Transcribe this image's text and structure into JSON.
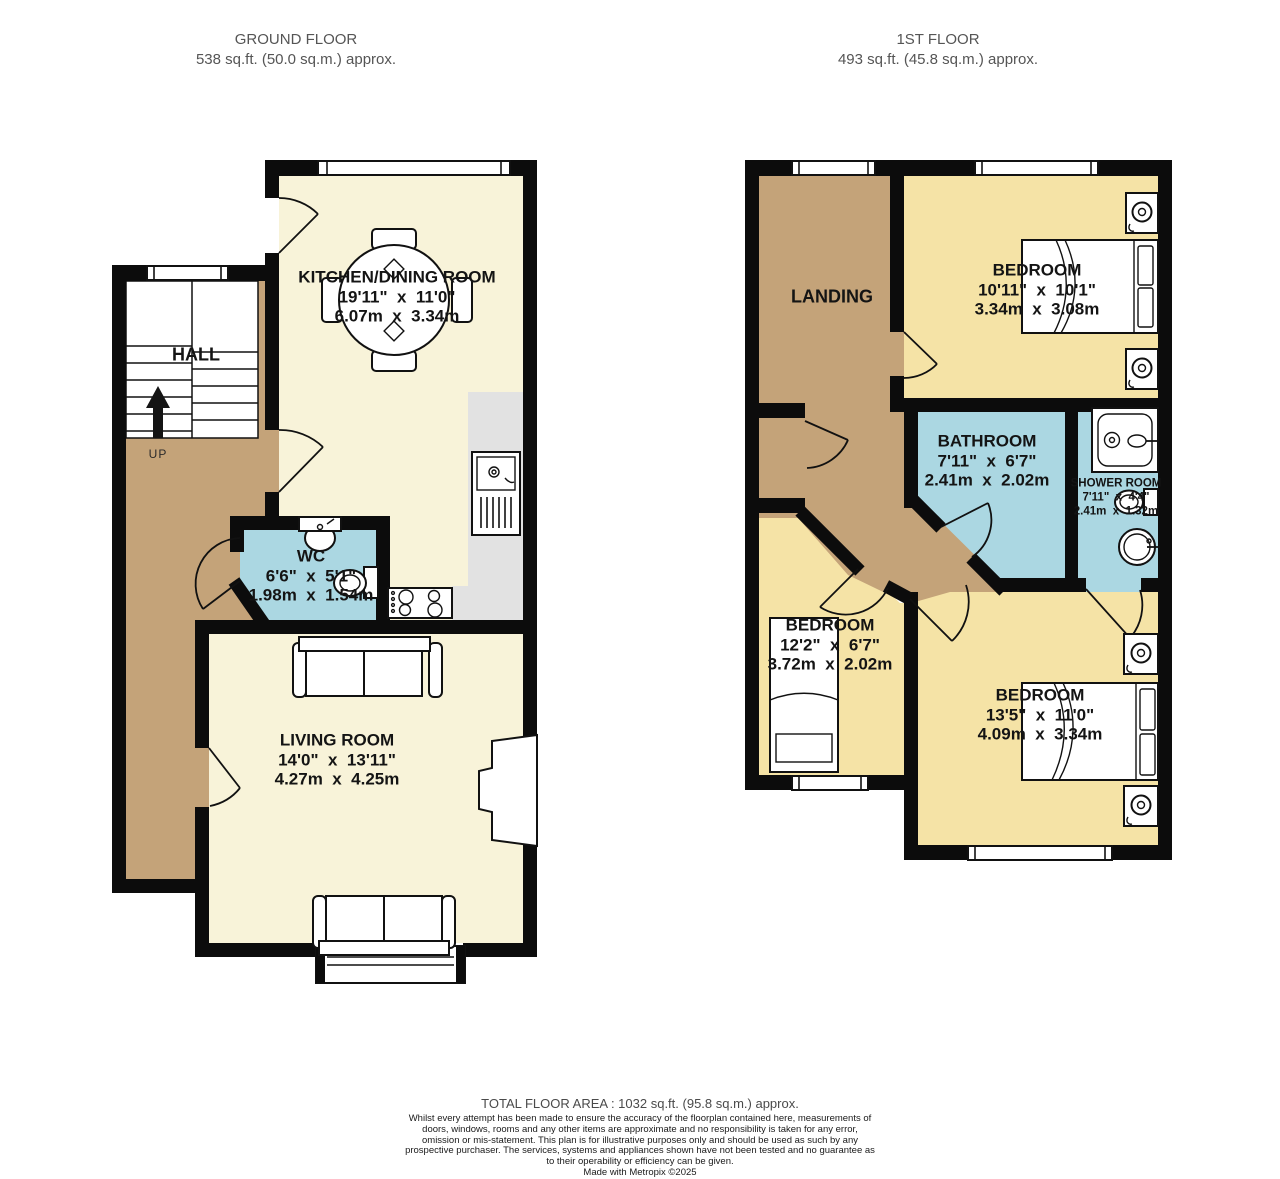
{
  "floors": {
    "ground": {
      "title": "GROUND FLOOR",
      "area": "538 sq.ft. (50.0 sq.m.) approx."
    },
    "first": {
      "title": "1ST FLOOR",
      "area": "493 sq.ft. (45.8 sq.m.) approx."
    }
  },
  "rooms": {
    "kitchen_dining": {
      "name": "KITCHEN/DINING ROOM",
      "imperial": "19'11\"  x  11'0\"",
      "metric": "6.07m  x  3.34m"
    },
    "hall": {
      "name": "HALL"
    },
    "stairs": {
      "direction_label": "UP"
    },
    "wc": {
      "name": "WC",
      "imperial": "6'6\"  x  5'1\"",
      "metric": "1.98m  x  1.54m"
    },
    "living_room": {
      "name": "LIVING ROOM",
      "imperial": "14'0\"  x  13'11\"",
      "metric": "4.27m  x  4.25m"
    },
    "landing": {
      "name": "LANDING"
    },
    "bedroom_1": {
      "name": "BEDROOM",
      "imperial": "10'11\"  x  10'1\"",
      "metric": "3.34m  x  3.08m"
    },
    "bathroom": {
      "name": "BATHROOM",
      "imperial": "7'11\"  x  6'7\"",
      "metric": "2.41m  x  2.02m"
    },
    "shower_room": {
      "name": "SHOWER ROOM",
      "imperial": "7'11\"  x  4'4\"",
      "metric": "2.41m  x  1.32m"
    },
    "bedroom_2": {
      "name": "BEDROOM",
      "imperial": "12'2\"  x  6'7\"",
      "metric": "3.72m  x  2.02m"
    },
    "bedroom_3": {
      "name": "BEDROOM",
      "imperial": "13'5\"  x  11'0\"",
      "metric": "4.09m  x  3.34m"
    }
  },
  "footer": {
    "total_area": "TOTAL FLOOR AREA : 1032 sq.ft. (95.8 sq.m.) approx.",
    "disclaimer": "Whilst every attempt has been made to ensure the accuracy of the floorplan contained here, measurements of doors, windows, rooms and any other items are approximate and no responsibility is taken for any error, omission or mis-statement. This plan is for illustrative purposes only and should be used as such by any prospective purchaser. The services, systems and appliances shown have not been tested and no guarantee as to their operability or efficiency can be given.",
    "credit": "Made with Metropix ©2025"
  },
  "colors": {
    "room_cream": "#f8f3d9",
    "room_yellow": "#f5e3a6",
    "room_tan": "#c4a379",
    "room_blue": "#abd7e2",
    "counter_gray": "#e2e2e2",
    "wall": "#0c0c0c",
    "title_gray": "#555555"
  }
}
